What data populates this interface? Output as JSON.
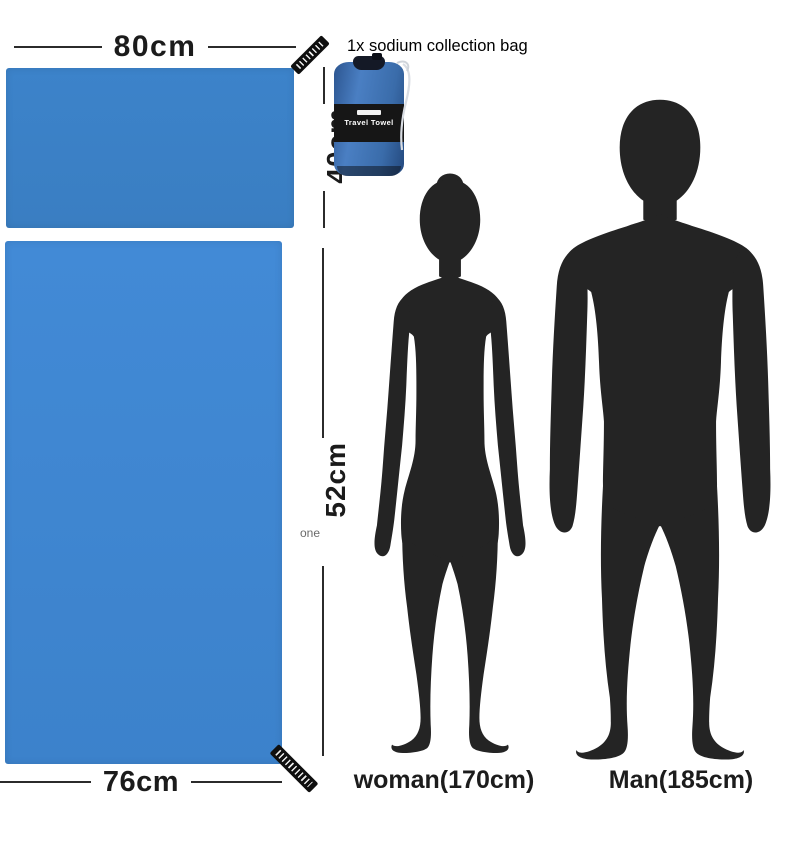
{
  "header": {
    "caption": "1x sodium collection bag"
  },
  "bag": {
    "label": "Travel Towel"
  },
  "small_towel": {
    "width_label": "80cm",
    "height_label": "40cm"
  },
  "large_towel": {
    "width_label": "76cm",
    "height_label": "52cm",
    "height_note": "one"
  },
  "figures": {
    "woman_label": "woman(170cm)",
    "man_label": "Man(185cm)"
  },
  "colors": {
    "towel_small": "#3a80c6",
    "towel_large": "#3f86d1",
    "silhouette": "#242424",
    "bag_body": "#3e6fae",
    "bag_band": "#161616",
    "dimension_line": "#2b2b2b",
    "note_gray": "#6a6a6a"
  }
}
